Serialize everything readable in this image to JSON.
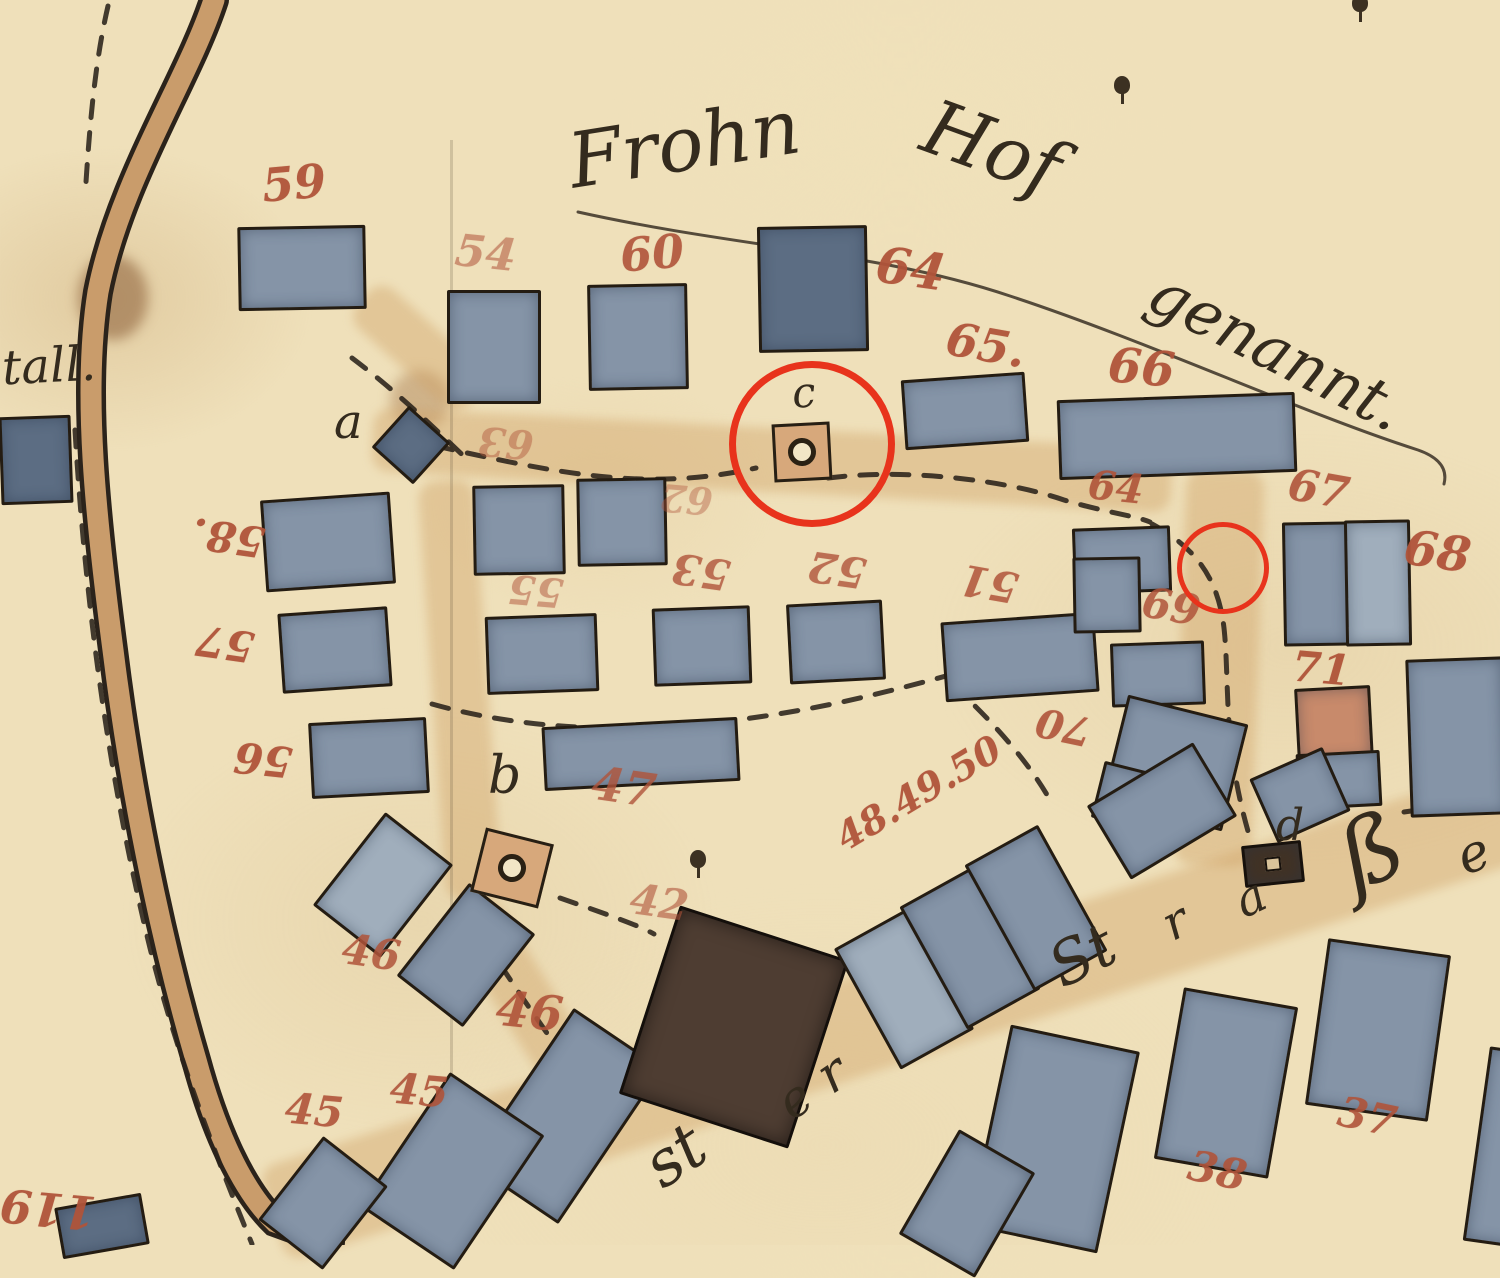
{
  "meta": {
    "title": "Historical cadastral plan — village block at the Frohn-Hof"
  },
  "palette": {
    "paper": "#efe0ba",
    "ink": "#342b1e",
    "number_red": "#b0543a",
    "building_gray": "#8594a7",
    "building_dark": "#5c6d83",
    "building_brown": "#4e3d32",
    "building_salmon": "#c88a6b",
    "road_tan": "#c99c6b",
    "annotation_red": "#e8331c"
  },
  "place_name": {
    "part1": "Frohn",
    "part2": "Hof",
    "part3": "genannt."
  },
  "script_texts": [
    {
      "name": "place-name-frohn",
      "text": "Frohn",
      "x": 568,
      "y": 106,
      "size": 76,
      "rot": -9
    },
    {
      "name": "place-name-hof",
      "text": "Hof",
      "x": 922,
      "y": 110,
      "size": 76,
      "rot": 20
    },
    {
      "name": "place-name-genannt",
      "text": "genannt.",
      "x": 1138,
      "y": 320,
      "size": 62,
      "rot": 27
    },
    {
      "name": "stall-label-fragment",
      "text": "tall.",
      "x": 2,
      "y": 342,
      "size": 48,
      "rot": -3
    },
    {
      "name": "letter-a",
      "text": "a",
      "x": 334,
      "y": 398,
      "size": 48,
      "rot": 0
    },
    {
      "name": "letter-c",
      "text": "c",
      "x": 792,
      "y": 372,
      "size": 42,
      "rot": -5
    },
    {
      "name": "letter-b",
      "text": "b",
      "x": 488,
      "y": 750,
      "size": 52,
      "rot": 0
    },
    {
      "name": "letter-d",
      "text": "d",
      "x": 1276,
      "y": 804,
      "size": 44,
      "rot": 0
    },
    {
      "name": "strasse-st",
      "text": "St",
      "x": 1050,
      "y": 926,
      "size": 60,
      "rot": -27
    },
    {
      "name": "strasse-r",
      "text": "r",
      "x": 1164,
      "y": 898,
      "size": 48,
      "rot": -27
    },
    {
      "name": "strasse-a",
      "text": "a",
      "x": 1236,
      "y": 874,
      "size": 48,
      "rot": -25
    },
    {
      "name": "strasse-sz",
      "text": "ß",
      "x": 1340,
      "y": 806,
      "size": 92,
      "rot": -22
    },
    {
      "name": "strasse-e",
      "text": "e",
      "x": 1458,
      "y": 828,
      "size": 52,
      "rot": -20
    },
    {
      "name": "stein-st",
      "text": "st",
      "x": 646,
      "y": 1124,
      "size": 64,
      "rot": -34
    },
    {
      "name": "stein-e",
      "text": "e",
      "x": 780,
      "y": 1074,
      "size": 50,
      "rot": -34
    },
    {
      "name": "stein-r",
      "text": "r",
      "x": 820,
      "y": 1048,
      "size": 52,
      "rot": -34
    }
  ],
  "plot_numbers": [
    {
      "text": "59",
      "x": 262,
      "y": 160,
      "size": 46,
      "rot": -5,
      "opacity": 0.95
    },
    {
      "text": "54",
      "x": 455,
      "y": 232,
      "size": 44,
      "rot": 6,
      "opacity": 0.55
    },
    {
      "text": "60",
      "x": 620,
      "y": 230,
      "size": 46,
      "rot": -5,
      "opacity": 0.9
    },
    {
      "text": "64",
      "x": 876,
      "y": 244,
      "size": 50,
      "rot": 8,
      "opacity": 0.95
    },
    {
      "text": "65.",
      "x": 946,
      "y": 322,
      "size": 46,
      "rot": 10,
      "opacity": 0.95
    },
    {
      "text": "66",
      "x": 1108,
      "y": 344,
      "size": 48,
      "rot": 5,
      "opacity": 0.95
    },
    {
      "text": "64",
      "x": 1088,
      "y": 468,
      "size": 40,
      "rot": 6,
      "opacity": 0.9
    },
    {
      "text": "67",
      "x": 1288,
      "y": 468,
      "size": 44,
      "rot": 10,
      "opacity": 0.9
    },
    {
      "text": "68",
      "x": 1404,
      "y": 528,
      "size": 48,
      "rot": 8,
      "opacity": 0.95
    },
    {
      "text": "69",
      "x": 1142,
      "y": 586,
      "size": 42,
      "rot": 10,
      "opacity": 0.85
    },
    {
      "text": "71",
      "x": 1292,
      "y": 648,
      "size": 42,
      "rot": 5,
      "opacity": 0.95
    },
    {
      "text": "70",
      "x": 1036,
      "y": 706,
      "size": 40,
      "rot": 192,
      "opacity": 0.9
    },
    {
      "text": "58.",
      "x": 192,
      "y": 516,
      "size": 42,
      "rot": 188,
      "opacity": 0.95
    },
    {
      "text": "57",
      "x": 196,
      "y": 622,
      "size": 42,
      "rot": 188,
      "opacity": 0.95
    },
    {
      "text": "56",
      "x": 234,
      "y": 738,
      "size": 42,
      "rot": 186,
      "opacity": 0.95
    },
    {
      "text": "55",
      "x": 508,
      "y": 570,
      "size": 40,
      "rot": 185,
      "opacity": 0.5
    },
    {
      "text": "53",
      "x": 672,
      "y": 550,
      "size": 42,
      "rot": 188,
      "opacity": 0.8
    },
    {
      "text": "52",
      "x": 808,
      "y": 548,
      "size": 42,
      "rot": 188,
      "opacity": 0.8
    },
    {
      "text": "51",
      "x": 960,
      "y": 562,
      "size": 42,
      "rot": 190,
      "opacity": 0.85
    },
    {
      "text": "63",
      "x": 478,
      "y": 422,
      "size": 40,
      "rot": 185,
      "opacity": 0.45
    },
    {
      "text": "62",
      "x": 660,
      "y": 480,
      "size": 38,
      "rot": 185,
      "opacity": 0.4
    },
    {
      "text": "47",
      "x": 592,
      "y": 764,
      "size": 46,
      "rot": 8,
      "opacity": 0.8
    },
    {
      "text": "42",
      "x": 630,
      "y": 882,
      "size": 42,
      "rot": 8,
      "opacity": 0.6
    },
    {
      "text": "46",
      "x": 342,
      "y": 932,
      "size": 42,
      "rot": 8,
      "opacity": 0.85
    },
    {
      "text": "46",
      "x": 496,
      "y": 988,
      "size": 48,
      "rot": 6,
      "opacity": 0.9
    },
    {
      "text": "45",
      "x": 285,
      "y": 1090,
      "size": 42,
      "rot": 5,
      "opacity": 0.9
    },
    {
      "text": "45",
      "x": 390,
      "y": 1070,
      "size": 42,
      "rot": 5,
      "opacity": 0.9
    },
    {
      "text": "48.49.50",
      "x": 826,
      "y": 774,
      "size": 38,
      "rot": -31,
      "opacity": 0.95
    },
    {
      "text": "38",
      "x": 1188,
      "y": 1150,
      "size": 42,
      "rot": 12,
      "opacity": 0.9
    },
    {
      "text": "37",
      "x": 1338,
      "y": 1096,
      "size": 42,
      "rot": 12,
      "opacity": 0.9
    },
    {
      "text": "119",
      "x": 0,
      "y": 1186,
      "size": 46,
      "rot": 185,
      "opacity": 0.95
    }
  ],
  "buildings": [
    {
      "x": 238,
      "y": 226,
      "w": 122,
      "h": 78,
      "rot": -1,
      "variant": ""
    },
    {
      "x": 447,
      "y": 290,
      "w": 88,
      "h": 108,
      "rot": 0,
      "variant": ""
    },
    {
      "x": 588,
      "y": 284,
      "w": 94,
      "h": 100,
      "rot": -1,
      "variant": ""
    },
    {
      "x": 758,
      "y": 226,
      "w": 104,
      "h": 120,
      "rot": -1,
      "variant": "dark"
    },
    {
      "x": 903,
      "y": 376,
      "w": 118,
      "h": 64,
      "rot": -4,
      "variant": ""
    },
    {
      "x": 1058,
      "y": 396,
      "w": 232,
      "h": 74,
      "rot": -2,
      "variant": ""
    },
    {
      "x": 383,
      "y": 417,
      "w": 50,
      "h": 50,
      "rot": 42,
      "variant": "dark"
    },
    {
      "x": 263,
      "y": 496,
      "w": 124,
      "h": 86,
      "rot": -4,
      "variant": ""
    },
    {
      "x": 280,
      "y": 610,
      "w": 104,
      "h": 74,
      "rot": -4,
      "variant": ""
    },
    {
      "x": 310,
      "y": 720,
      "w": 112,
      "h": 70,
      "rot": -3,
      "variant": ""
    },
    {
      "x": 473,
      "y": 485,
      "w": 86,
      "h": 84,
      "rot": -1,
      "variant": ""
    },
    {
      "x": 577,
      "y": 478,
      "w": 84,
      "h": 82,
      "rot": -1,
      "variant": ""
    },
    {
      "x": 486,
      "y": 615,
      "w": 106,
      "h": 72,
      "rot": -2,
      "variant": ""
    },
    {
      "x": 653,
      "y": 607,
      "w": 92,
      "h": 72,
      "rot": -2,
      "variant": ""
    },
    {
      "x": 788,
      "y": 602,
      "w": 90,
      "h": 74,
      "rot": -3,
      "variant": ""
    },
    {
      "x": 943,
      "y": 617,
      "w": 148,
      "h": 74,
      "rot": -4,
      "variant": ""
    },
    {
      "x": 1073,
      "y": 527,
      "w": 92,
      "h": 60,
      "rot": -2,
      "variant": ""
    },
    {
      "x": 1073,
      "y": 557,
      "w": 62,
      "h": 70,
      "rot": -1,
      "variant": ""
    },
    {
      "x": 1111,
      "y": 642,
      "w": 88,
      "h": 58,
      "rot": -2,
      "variant": ""
    },
    {
      "x": 1283,
      "y": 522,
      "w": 60,
      "h": 118,
      "rot": -1,
      "variant": ""
    },
    {
      "x": 1345,
      "y": 520,
      "w": 60,
      "h": 120,
      "rot": -1,
      "variant": "light"
    },
    {
      "x": 1296,
      "y": 687,
      "w": 70,
      "h": 68,
      "rot": -3,
      "variant": "salmon"
    },
    {
      "x": 1297,
      "y": 752,
      "w": 78,
      "h": 50,
      "rot": -3,
      "variant": ""
    },
    {
      "x": 1408,
      "y": 658,
      "w": 92,
      "h": 152,
      "rot": -2,
      "variant": ""
    },
    {
      "x": 1113,
      "y": 708,
      "w": 118,
      "h": 104,
      "rot": 14,
      "variant": ""
    },
    {
      "x": 1097,
      "y": 766,
      "w": 44,
      "h": 52,
      "rot": 14,
      "variant": ""
    },
    {
      "x": 543,
      "y": 722,
      "w": 190,
      "h": 58,
      "rot": -3,
      "variant": ""
    },
    {
      "x": 340,
      "y": 826,
      "w": 80,
      "h": 112,
      "rot": 38,
      "variant": "light"
    },
    {
      "x": 424,
      "y": 896,
      "w": 78,
      "h": 112,
      "rot": 38,
      "variant": ""
    },
    {
      "x": 512,
      "y": 1022,
      "w": 102,
      "h": 182,
      "rot": 34,
      "variant": ""
    },
    {
      "x": 395,
      "y": 1090,
      "w": 108,
      "h": 156,
      "rot": 34,
      "variant": ""
    },
    {
      "x": 282,
      "y": 1150,
      "w": 76,
      "h": 100,
      "rot": 38,
      "variant": ""
    },
    {
      "x": 58,
      "y": 1200,
      "w": 82,
      "h": 46,
      "rot": -10,
      "variant": "dark"
    },
    {
      "x": 645,
      "y": 928,
      "w": 172,
      "h": 192,
      "rot": 18,
      "variant": "brown"
    },
    {
      "x": 862,
      "y": 920,
      "w": 78,
      "h": 132,
      "rot": -29,
      "variant": "light"
    },
    {
      "x": 928,
      "y": 878,
      "w": 78,
      "h": 134,
      "rot": -29,
      "variant": ""
    },
    {
      "x": 994,
      "y": 836,
      "w": 78,
      "h": 138,
      "rot": -29,
      "variant": ""
    },
    {
      "x": 988,
      "y": 1036,
      "w": 126,
      "h": 200,
      "rot": 12,
      "variant": ""
    },
    {
      "x": 923,
      "y": 1143,
      "w": 82,
      "h": 115,
      "rot": 30,
      "variant": ""
    },
    {
      "x": 1168,
      "y": 996,
      "w": 110,
      "h": 168,
      "rot": 10,
      "variant": ""
    },
    {
      "x": 1316,
      "y": 946,
      "w": 118,
      "h": 162,
      "rot": 8,
      "variant": ""
    },
    {
      "x": 1476,
      "y": 1050,
      "w": 60,
      "h": 190,
      "rot": 8,
      "variant": ""
    },
    {
      "x": 1243,
      "y": 843,
      "w": 54,
      "h": 36,
      "rot": -6,
      "variant": "pump"
    },
    {
      "x": 1100,
      "y": 768,
      "w": 118,
      "h": 80,
      "rot": -31,
      "variant": ""
    },
    {
      "x": 1260,
      "y": 760,
      "w": 74,
      "h": 64,
      "rot": -24,
      "variant": ""
    },
    {
      "x": 0,
      "y": 416,
      "w": 66,
      "h": 82,
      "rot": -2,
      "variant": "dark"
    }
  ],
  "wells": [
    {
      "name": "well-c",
      "x": 773,
      "y": 423,
      "w": 52,
      "h": 52,
      "rot": -3
    },
    {
      "name": "well-b",
      "x": 477,
      "y": 835,
      "w": 64,
      "h": 60,
      "rot": 14
    }
  ],
  "trees": [
    {
      "x": 690,
      "y": 850
    },
    {
      "x": 1114,
      "y": 76
    },
    {
      "x": 1352,
      "y": -6
    }
  ],
  "annotations": {
    "color": "#e8331c",
    "circles": [
      {
        "cx": 805,
        "cy": 437,
        "r": 76,
        "stroke": 7
      },
      {
        "cx": 1218,
        "cy": 563,
        "r": 41,
        "stroke": 5
      }
    ]
  },
  "streets_tan": [
    {
      "x": 372,
      "y": 428,
      "w": 800,
      "h": 64,
      "rot": 3
    },
    {
      "x": 344,
      "y": 322,
      "w": 150,
      "h": 52,
      "rot": 42
    },
    {
      "x": 1180,
      "y": 470,
      "w": 78,
      "h": 396,
      "rot": 2
    },
    {
      "x": 240,
      "y": 960,
      "w": 1340,
      "h": 98,
      "rot": -18
    },
    {
      "x": 507,
      "y": 890,
      "w": 56,
      "h": 250,
      "rot": -32
    },
    {
      "x": 432,
      "y": 480,
      "w": 56,
      "h": 420,
      "rot": -4
    }
  ]
}
